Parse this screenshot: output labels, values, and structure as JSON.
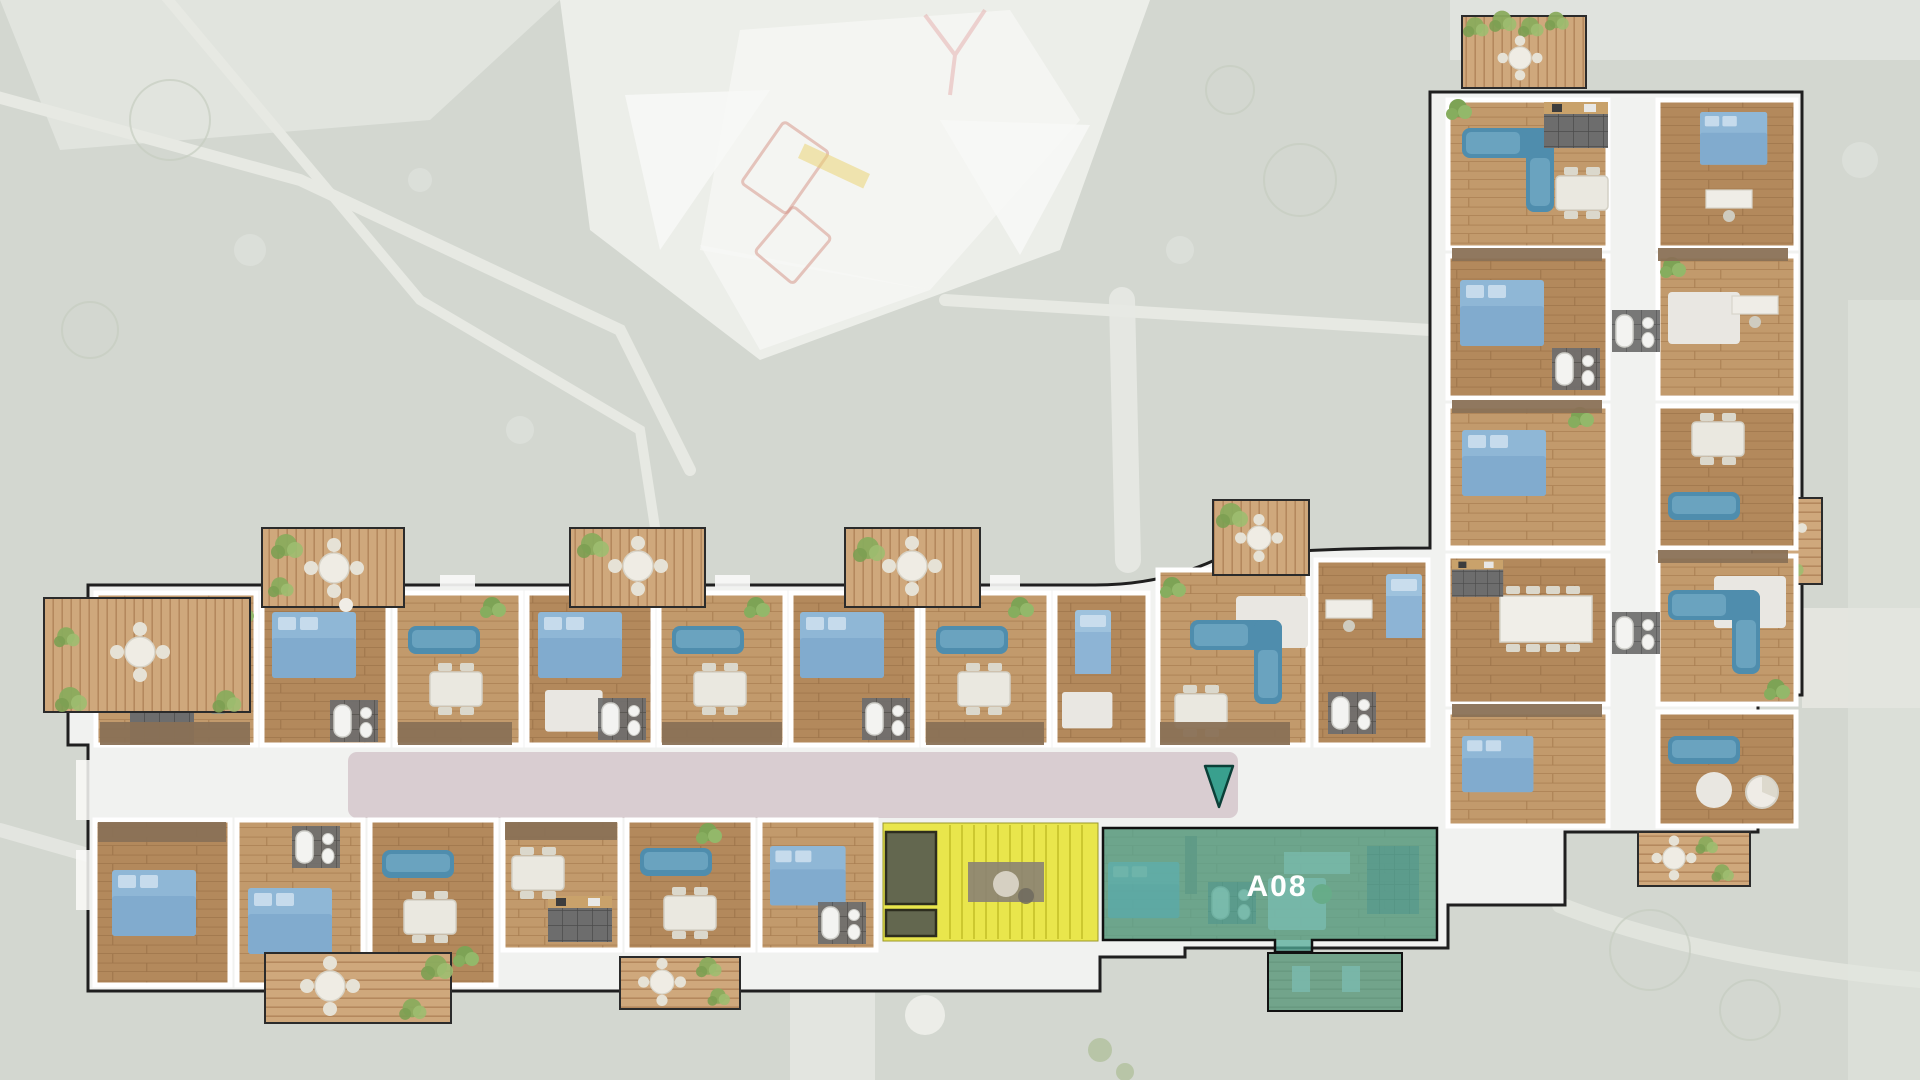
{
  "highlights": {
    "selected_unit": {
      "label": "A08",
      "fill": "#4fa897",
      "text_color": "#ffffff"
    },
    "selected_unit_terrace": {
      "fill": "#45a292"
    },
    "stair_core": {
      "fill": "#e8e43a"
    }
  },
  "marker": {
    "name": "unit-entrance-marker",
    "shape": "triangle-down",
    "fill": "#39a08e",
    "stroke": "#0b4038"
  },
  "palette": {
    "site_background": "#d3d7d0",
    "path": "#e7e9e3",
    "building_fill": "#f1f2f0",
    "building_outline": "#1f1f1f",
    "corridor": "#d9cdd1",
    "wood_floor": "#b3895c",
    "wood_floor_light": "#c29a6c",
    "deck_wood": "#cfa87c",
    "wardrobe_brown": "#8a7156",
    "tile_dark": "#6a6a6a",
    "bed_blue": "#8fb7d6",
    "sofa_blue": "#4f8dad",
    "plant_green": "#7da355"
  }
}
